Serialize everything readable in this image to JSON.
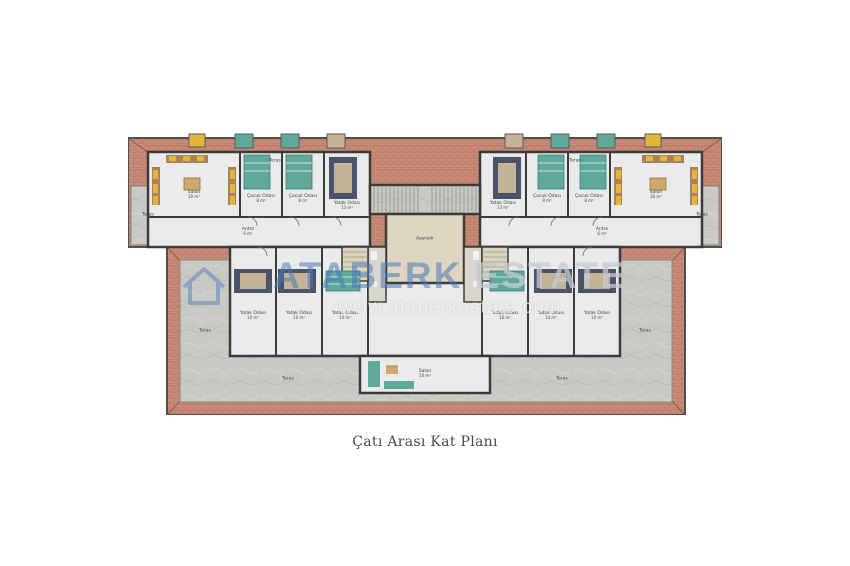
{
  "page": {
    "background": "#ffffff",
    "caption": "Çatı Arası Kat Planı"
  },
  "watermark": {
    "brand_primary": "ATABERK",
    "brand_secondary": "ESTATE",
    "website": "www.ataberkestate.com",
    "brand_color": "#4a78b9"
  },
  "palette": {
    "roof": "#c98a76",
    "roofline": "#a5705e",
    "ridge": "#8d5b49",
    "outline": "#4f4f4f",
    "wall": "#3b3b3b",
    "marble": "#c9c9c4",
    "marbleline": "#b2b2ac",
    "floor": "#e9ebeb",
    "lobby": "#ddd5c0",
    "bath": "#d8d5cd",
    "stair": "#d9d2bd",
    "bednavy": "#49546b",
    "bedlinen": "#c4b394",
    "bedteal": "#5ea99a",
    "sofabrown": "#a9825c",
    "sofayellow": "#e3b53a",
    "tabletan": "#cfa96c"
  },
  "plan": {
    "rooms": [
      {
        "label": "Salon",
        "area": "30 m²",
        "x": 66,
        "y": 64
      },
      {
        "label": "Çocuk Odası",
        "area": "8 m²",
        "x": 133,
        "y": 68
      },
      {
        "label": "Çocuk Odası",
        "area": "8 m²",
        "x": 175,
        "y": 68
      },
      {
        "label": "Yatak Odası",
        "area": "13 m²",
        "x": 219,
        "y": 75
      },
      {
        "label": "Antre",
        "area": "6 m²",
        "x": 120,
        "y": 101
      },
      {
        "label": "Teras",
        "area": "",
        "x": 20,
        "y": 84
      },
      {
        "label": "Teras",
        "area": "",
        "x": 147,
        "y": 30
      },
      {
        "label": "Teras",
        "area": "",
        "x": 447,
        "y": 30
      },
      {
        "label": "Teras",
        "area": "",
        "x": 574,
        "y": 84
      },
      {
        "label": "Salon",
        "area": "30 m²",
        "x": 528,
        "y": 64
      },
      {
        "label": "Çocuk Odası",
        "area": "8 m²",
        "x": 419,
        "y": 68
      },
      {
        "label": "Çocuk Odası",
        "area": "8 m²",
        "x": 461,
        "y": 68
      },
      {
        "label": "Yatak Odası",
        "area": "13 m²",
        "x": 375,
        "y": 75
      },
      {
        "label": "Antre",
        "area": "6 m²",
        "x": 474,
        "y": 101
      },
      {
        "label": "Asansör",
        "area": "",
        "x": 297,
        "y": 108
      },
      {
        "label": "Yatak Odası",
        "area": "10 m²",
        "x": 125,
        "y": 185
      },
      {
        "label": "Yatak Odası",
        "area": "10 m²",
        "x": 171,
        "y": 185
      },
      {
        "label": "Yatak Odası",
        "area": "10 m²",
        "x": 217,
        "y": 185
      },
      {
        "label": "Yatak Odası",
        "area": "10 m²",
        "x": 377,
        "y": 185
      },
      {
        "label": "Yatak Odası",
        "area": "10 m²",
        "x": 423,
        "y": 185
      },
      {
        "label": "Yatak Odası",
        "area": "10 m²",
        "x": 469,
        "y": 185
      },
      {
        "label": "Salon",
        "area": "10 m²",
        "x": 297,
        "y": 243
      },
      {
        "label": "Teras",
        "area": "",
        "x": 77,
        "y": 200
      },
      {
        "label": "Teras",
        "area": "",
        "x": 517,
        "y": 200
      },
      {
        "label": "Teras",
        "area": "",
        "x": 160,
        "y": 248
      },
      {
        "label": "Teras",
        "area": "",
        "x": 434,
        "y": 248
      }
    ]
  }
}
